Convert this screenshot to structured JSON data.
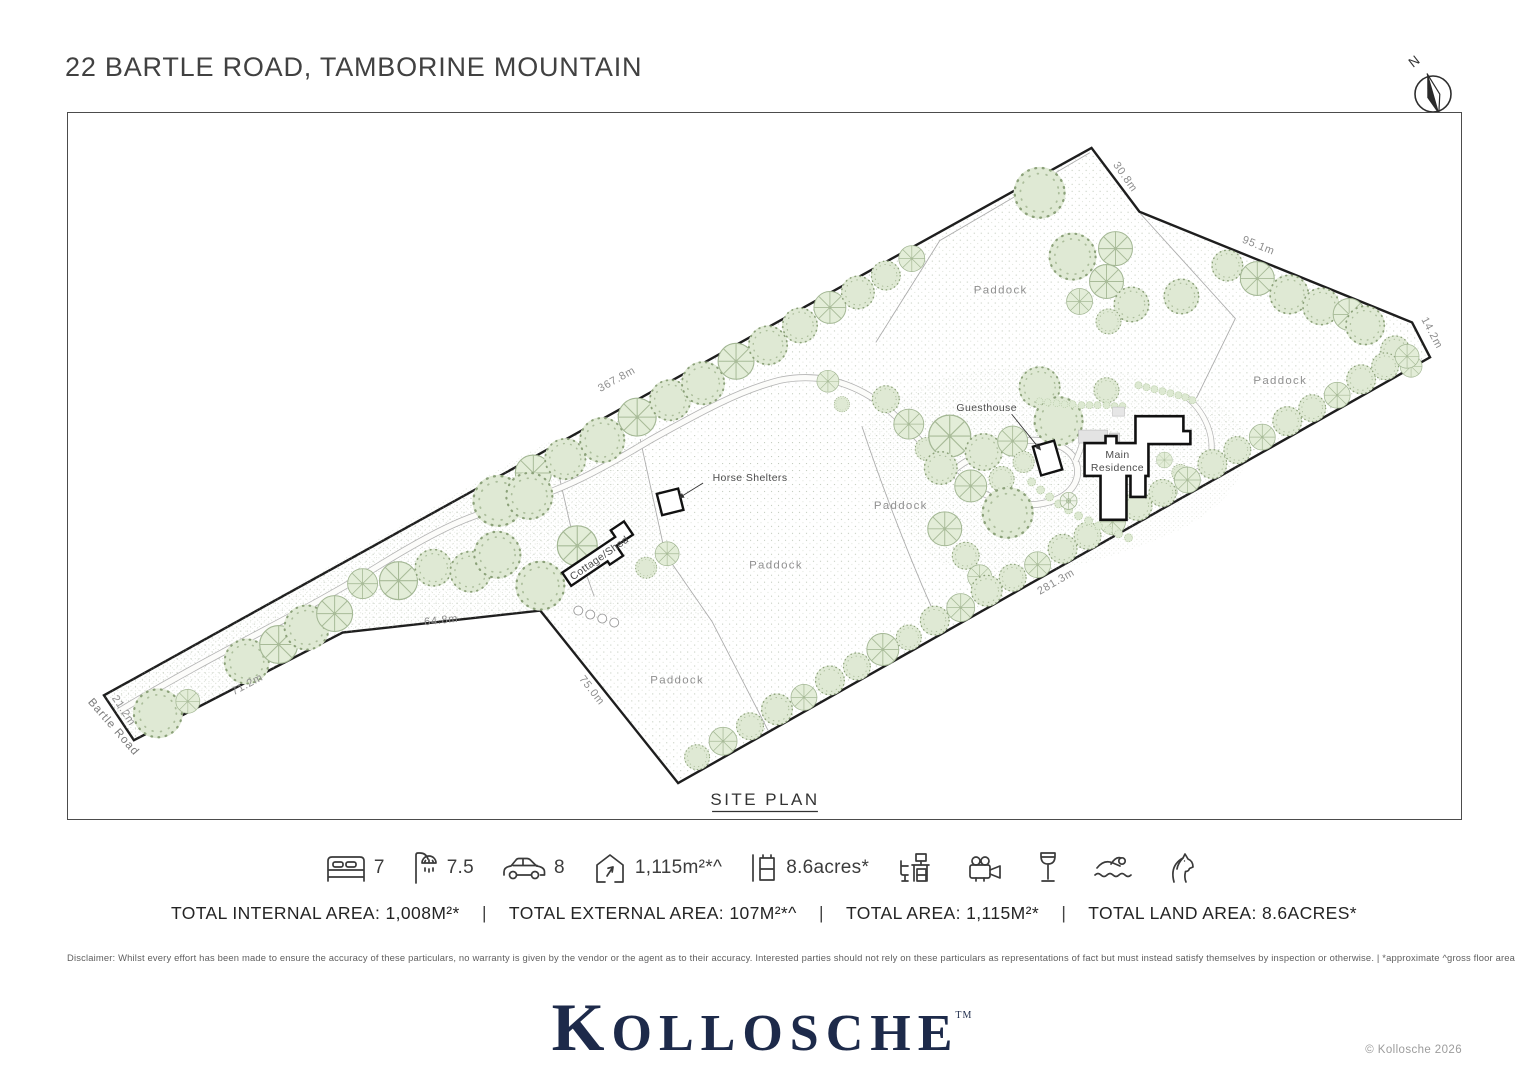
{
  "header": {
    "title": "22 BARTLE ROAD, TAMBORINE MOUNTAIN"
  },
  "compass": {
    "label": "N"
  },
  "plan": {
    "caption": "SITE PLAN",
    "road": "Bartle Road",
    "paddocks": [
      "Paddock",
      "Paddock",
      "Paddock",
      "Paddock",
      "Paddock"
    ],
    "buildings": {
      "main_line1": "Main",
      "main_line2": "Residence",
      "guesthouse": "Guesthouse",
      "horse_shelters": "Horse Shelters",
      "cottage_shed": "Cottage/Shed"
    },
    "dims": {
      "d367": "367.8m",
      "d30": "30.8m",
      "d95": "95.1m",
      "d14": "14.2m",
      "d281": "281.3m",
      "d75": "75.0m",
      "d64": "64.8m",
      "d71": "71.2m",
      "d21": "21.2m"
    }
  },
  "features": {
    "items": [
      {
        "icon": "bed-icon",
        "value": "7"
      },
      {
        "icon": "bath-icon",
        "value": "7.5"
      },
      {
        "icon": "car-icon",
        "value": "8"
      },
      {
        "icon": "floor-area-icon",
        "value": "1,115m²*^"
      },
      {
        "icon": "land-area-icon",
        "value": "8.6acres*"
      },
      {
        "icon": "office-icon",
        "value": ""
      },
      {
        "icon": "cinema-icon",
        "value": ""
      },
      {
        "icon": "wine-icon",
        "value": ""
      },
      {
        "icon": "pool-icon",
        "value": ""
      },
      {
        "icon": "horse-icon",
        "value": ""
      }
    ]
  },
  "totals": {
    "separator": "|",
    "segments": [
      "TOTAL INTERNAL AREA: 1,008M²*",
      "TOTAL EXTERNAL AREA: 107M²*^",
      "TOTAL AREA: 1,115M²*",
      "TOTAL LAND AREA: 8.6ACRES*"
    ]
  },
  "disclaimer": "Disclaimer: Whilst every effort has been made to ensure the accuracy of these particulars, no warranty is given by the vendor or the agent as to their accuracy. Interested parties should not rely on these particulars as representations of fact but must instead satisfy themselves by inspection or otherwise.  |  *approximate ^gross floor area",
  "footer": {
    "logo": "KOLLOSCHE",
    "logo_tm": "TM",
    "copyright": "© Kollosche 2026"
  },
  "colors": {
    "brand_navy": "#1d2a4a",
    "tree_fill": "#dfe9d4",
    "boundary": "#1e1e1e"
  }
}
